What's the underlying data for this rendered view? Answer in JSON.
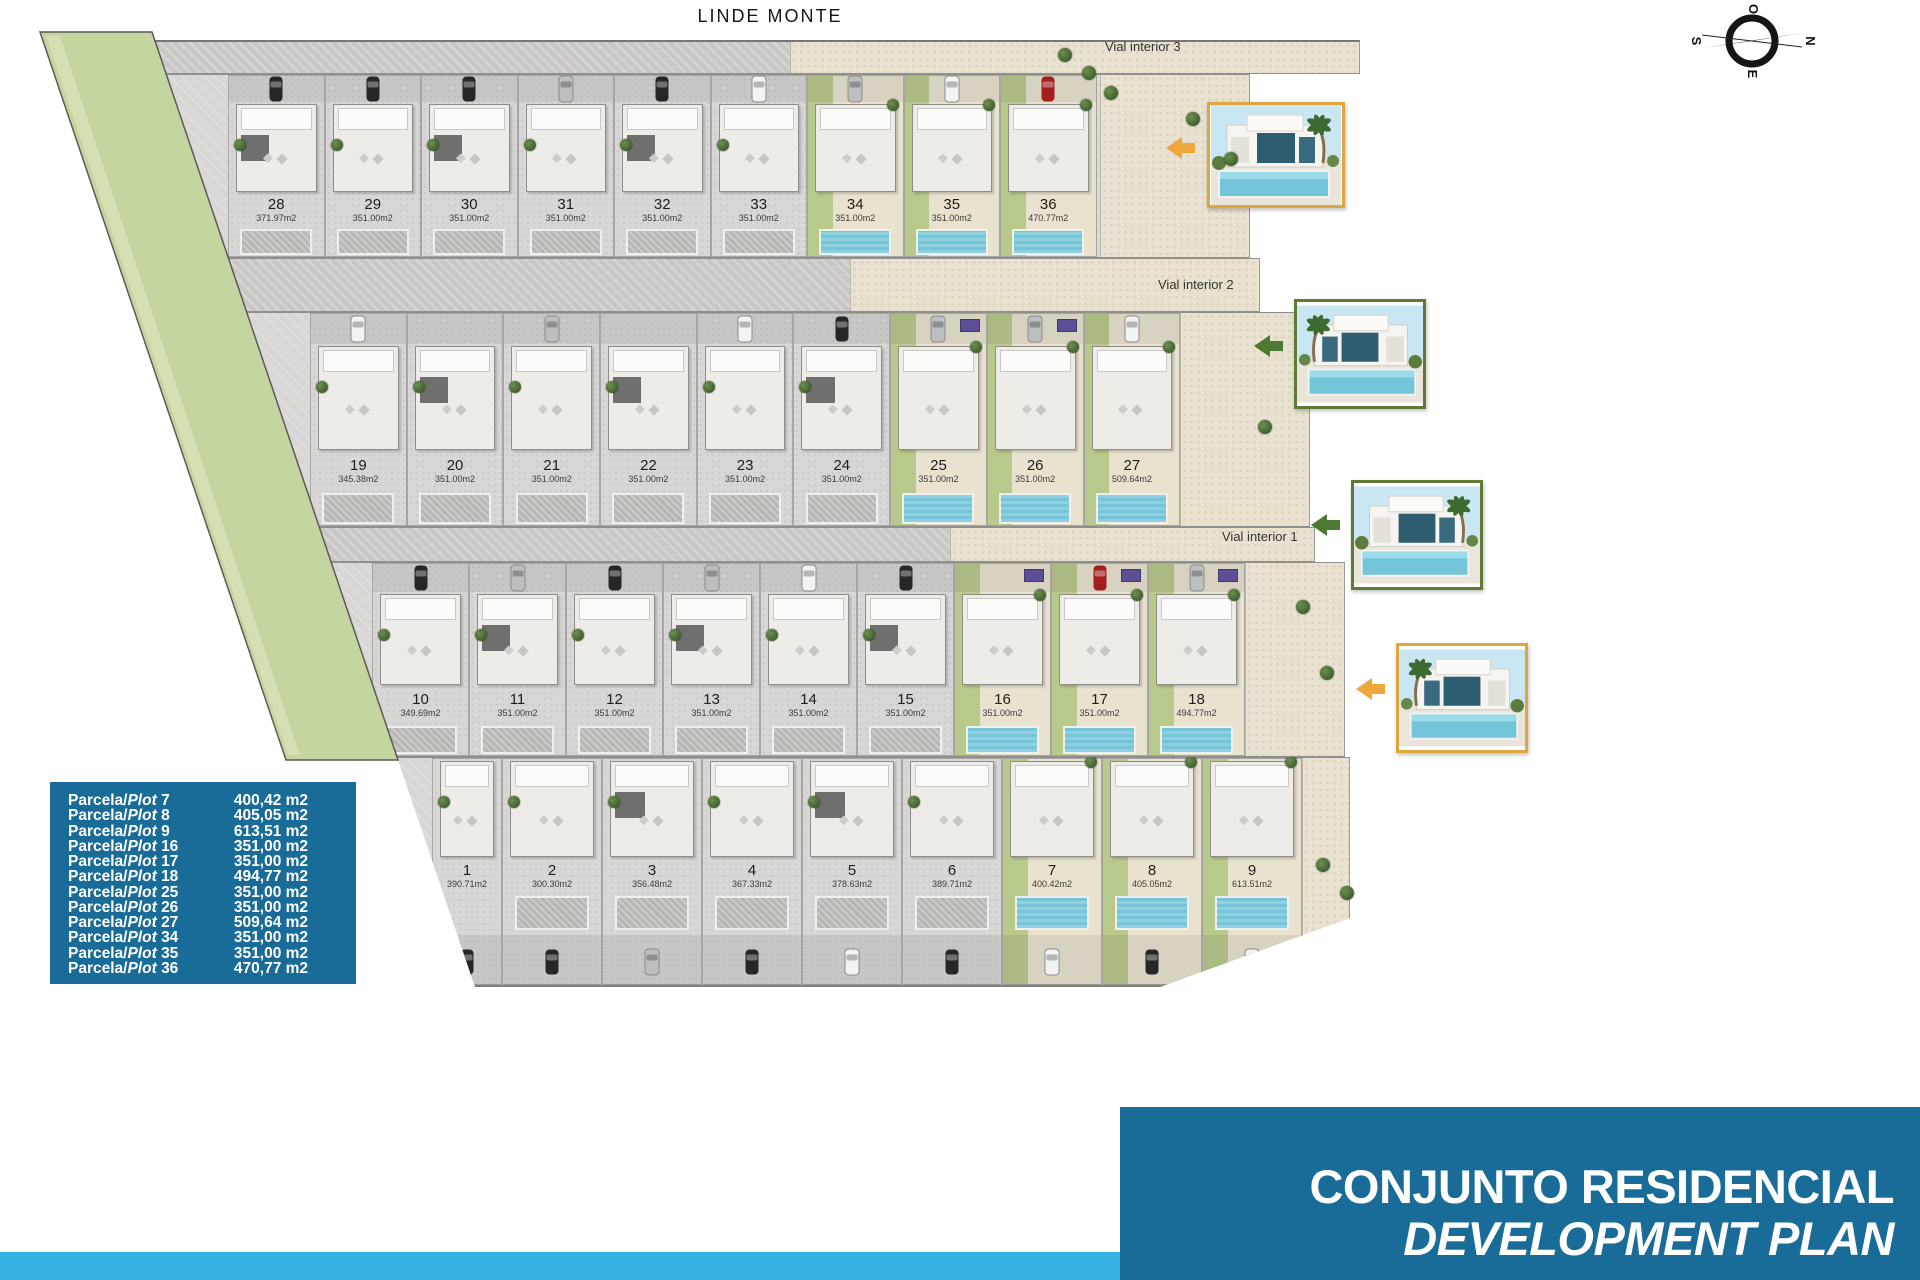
{
  "page": {
    "title": "LINDE MONTE"
  },
  "compass": {
    "top": "O",
    "right": "N",
    "bottom": "E",
    "left": "S"
  },
  "streets": [
    {
      "label": "Vial interior 3"
    },
    {
      "label": "Vial interior 2"
    },
    {
      "label": "Vial interior 1"
    }
  ],
  "plan": {
    "rows": [
      {
        "name": "row-1",
        "plots": [
          {
            "num": "28",
            "area": "371.97m2",
            "type": "gray",
            "pool": "gray",
            "car": "dark",
            "dark_roof": true,
            "panel": false
          },
          {
            "num": "29",
            "area": "351.00m2",
            "type": "gray",
            "pool": "gray",
            "car": "dark",
            "dark_roof": false,
            "panel": false
          },
          {
            "num": "30",
            "area": "351.00m2",
            "type": "gray",
            "pool": "gray",
            "car": "dark",
            "dark_roof": true,
            "panel": false
          },
          {
            "num": "31",
            "area": "351.00m2",
            "type": "gray",
            "pool": "gray",
            "car": "silver",
            "dark_roof": false,
            "panel": false
          },
          {
            "num": "32",
            "area": "351.00m2",
            "type": "gray",
            "pool": "gray",
            "car": "dark",
            "dark_roof": true,
            "panel": false
          },
          {
            "num": "33",
            "area": "351.00m2",
            "type": "gray",
            "pool": "gray",
            "car": "white",
            "dark_roof": false,
            "panel": false
          },
          {
            "num": "34",
            "area": "351.00m2",
            "type": "green",
            "pool": "blue",
            "car": "silver",
            "dark_roof": false,
            "panel": false
          },
          {
            "num": "35",
            "area": "351.00m2",
            "type": "green",
            "pool": "blue",
            "car": "white",
            "dark_roof": false,
            "panel": false
          },
          {
            "num": "36",
            "area": "470.77m2",
            "type": "green",
            "pool": "blue",
            "car": "red",
            "dark_roof": false,
            "panel": false
          }
        ]
      },
      {
        "name": "row-2",
        "plots": [
          {
            "num": "19",
            "area": "345.38m2",
            "type": "gray",
            "pool": "gray",
            "car": "white",
            "dark_roof": false,
            "panel": false
          },
          {
            "num": "20",
            "area": "351.00m2",
            "type": "gray",
            "pool": "gray",
            "car": null,
            "dark_roof": true,
            "panel": false
          },
          {
            "num": "21",
            "area": "351.00m2",
            "type": "gray",
            "pool": "gray",
            "car": "silver",
            "dark_roof": false,
            "panel": false
          },
          {
            "num": "22",
            "area": "351.00m2",
            "type": "gray",
            "pool": "gray",
            "car": null,
            "dark_roof": true,
            "panel": false
          },
          {
            "num": "23",
            "area": "351.00m2",
            "type": "gray",
            "pool": "gray",
            "car": "white",
            "dark_roof": false,
            "panel": false
          },
          {
            "num": "24",
            "area": "351.00m2",
            "type": "gray",
            "pool": "gray",
            "car": "dark",
            "dark_roof": true,
            "panel": false
          },
          {
            "num": "25",
            "area": "351.00m2",
            "type": "green",
            "pool": "blue",
            "car": "silver",
            "dark_roof": false,
            "panel": true
          },
          {
            "num": "26",
            "area": "351.00m2",
            "type": "green",
            "pool": "blue",
            "car": "silver",
            "dark_roof": false,
            "panel": true
          },
          {
            "num": "27",
            "area": "509.64m2",
            "type": "green",
            "pool": "blue",
            "car": "white",
            "dark_roof": false,
            "panel": false
          }
        ]
      },
      {
        "name": "row-3",
        "plots": [
          {
            "num": "10",
            "area": "349.69m2",
            "type": "gray",
            "pool": "gray",
            "car": "dark",
            "dark_roof": false,
            "panel": false
          },
          {
            "num": "11",
            "area": "351.00m2",
            "type": "gray",
            "pool": "gray",
            "car": "silver",
            "dark_roof": true,
            "panel": false
          },
          {
            "num": "12",
            "area": "351.00m2",
            "type": "gray",
            "pool": "gray",
            "car": "dark",
            "dark_roof": false,
            "panel": false
          },
          {
            "num": "13",
            "area": "351.00m2",
            "type": "gray",
            "pool": "gray",
            "car": "silver",
            "dark_roof": true,
            "panel": false
          },
          {
            "num": "14",
            "area": "351.00m2",
            "type": "gray",
            "pool": "gray",
            "car": "white",
            "dark_roof": false,
            "panel": false
          },
          {
            "num": "15",
            "area": "351.00m2",
            "type": "gray",
            "pool": "gray",
            "car": "dark",
            "dark_roof": true,
            "panel": false
          },
          {
            "num": "16",
            "area": "351.00m2",
            "type": "green",
            "pool": "blue",
            "car": null,
            "dark_roof": false,
            "panel": true
          },
          {
            "num": "17",
            "area": "351.00m2",
            "type": "green",
            "pool": "blue",
            "car": "red",
            "dark_roof": false,
            "panel": true
          },
          {
            "num": "18",
            "area": "494.77m2",
            "type": "green",
            "pool": "blue",
            "car": "silver",
            "dark_roof": false,
            "panel": true
          }
        ]
      },
      {
        "name": "row-4",
        "plots": [
          {
            "num": "1",
            "area": "390.71m2",
            "type": "gray",
            "pool": null,
            "car": "dark",
            "dark_roof": false,
            "panel": false,
            "narrow": true
          },
          {
            "num": "2",
            "area": "300.30m2",
            "type": "gray",
            "pool": "gray",
            "car": "dark",
            "dark_roof": false,
            "panel": false
          },
          {
            "num": "3",
            "area": "356.48m2",
            "type": "gray",
            "pool": "gray",
            "car": "silver",
            "dark_roof": true,
            "panel": false
          },
          {
            "num": "4",
            "area": "367.33m2",
            "type": "gray",
            "pool": "gray",
            "car": "dark",
            "dark_roof": false,
            "panel": false
          },
          {
            "num": "5",
            "area": "378.63m2",
            "type": "gray",
            "pool": "gray",
            "car": "white",
            "dark_roof": true,
            "panel": false
          },
          {
            "num": "6",
            "area": "389.71m2",
            "type": "gray",
            "pool": "gray",
            "car": "dark",
            "dark_roof": false,
            "panel": false
          },
          {
            "num": "7",
            "area": "400.42m2",
            "type": "green",
            "pool": "blue",
            "car": "white",
            "dark_roof": false,
            "panel": false
          },
          {
            "num": "8",
            "area": "405.05m2",
            "type": "green",
            "pool": "blue",
            "car": "dark",
            "dark_roof": false,
            "panel": false
          },
          {
            "num": "9",
            "area": "613.51m2",
            "type": "green",
            "pool": "blue",
            "car": "white",
            "dark_roof": false,
            "panel": false
          }
        ]
      }
    ]
  },
  "legend": {
    "rows": [
      {
        "es": "Parcela/",
        "en": "Plot",
        "num": "7",
        "area": "400,42 m2"
      },
      {
        "es": "Parcela/",
        "en": "Plot",
        "num": "8",
        "area": "405,05 m2"
      },
      {
        "es": "Parcela/",
        "en": "Plot",
        "num": "9",
        "area": "613,51 m2"
      },
      {
        "es": "Parcela/",
        "en": "Plot",
        "num": "16",
        "area": "351,00 m2"
      },
      {
        "es": "Parcela/",
        "en": "Plot",
        "num": "17",
        "area": "351,00 m2"
      },
      {
        "es": "Parcela/",
        "en": "Plot",
        "num": "18",
        "area": "494,77 m2"
      },
      {
        "es": "Parcela/",
        "en": "Plot",
        "num": "25",
        "area": "351,00 m2"
      },
      {
        "es": "Parcela/",
        "en": "Plot",
        "num": "26",
        "area": "351,00 m2"
      },
      {
        "es": "Parcela/",
        "en": "Plot",
        "num": "27",
        "area": "509,64 m2"
      },
      {
        "es": "Parcela/",
        "en": "Plot",
        "num": "34",
        "area": "351,00 m2"
      },
      {
        "es": "Parcela/",
        "en": "Plot",
        "num": "35",
        "area": "351,00 m2"
      },
      {
        "es": "Parcela/",
        "en": "Plot",
        "num": "36",
        "area": "470,77 m2"
      }
    ]
  },
  "footer": {
    "line1": "CONJUNTO RESIDENCIAL",
    "line2": "DEVELOPMENT PLAN"
  },
  "colors": {
    "brand_blue": "#1a6c98",
    "accent_cyan": "#35b2e2",
    "verge_green": "#c5d5a0",
    "pebble_beige": "#e9e2d0",
    "pool_blue": "#85cbdd",
    "garden_olive": "#b8c98c",
    "arrow_orange": "#efa73c",
    "arrow_green": "#4c7a33"
  }
}
